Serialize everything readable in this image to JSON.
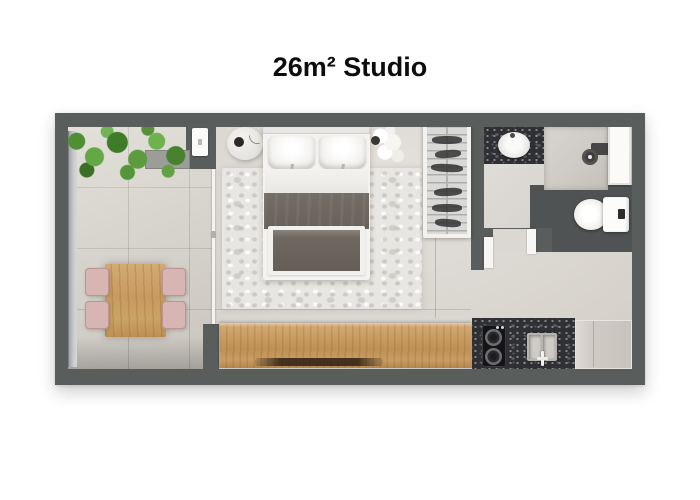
{
  "title": "26m² Studio",
  "plan": {
    "type": "apartment-floor-plan",
    "area_label": "26m²",
    "unit_type": "Studio",
    "rooms": [
      {
        "name": "balcony",
        "features": [
          "planter-plants",
          "dining-table",
          "four-pink-chairs",
          "glass-railing"
        ]
      },
      {
        "name": "living-bedroom",
        "features": [
          "double-bed",
          "round-nightstand",
          "rug",
          "flower-vase",
          "wardrobe-with-hangers",
          "wood-sideboard",
          "sliding-glass-door"
        ]
      },
      {
        "name": "bathroom",
        "features": [
          "vanity-sink",
          "shower",
          "glass-shelf",
          "toilet",
          "door-opening"
        ]
      },
      {
        "name": "kitchen",
        "features": [
          "two-burner-stove",
          "double-sink",
          "faucet",
          "fridge",
          "granite-counter"
        ]
      },
      {
        "name": "entry",
        "features": [
          "entry-door-opening"
        ]
      }
    ],
    "colors": {
      "wall": "#595d5c",
      "floor_living": "#dbd7d1",
      "floor_balcony": "#d6d2ca",
      "rug": "#e8e6e2",
      "wood": "#c79a60",
      "chair_pink": "#d7b5b2",
      "plant_green": "#55963a",
      "granite": "#2e3034",
      "blanket": "#6e6761",
      "fixtures_white": "#f4f3f1",
      "toilet_nook": "#4f5353",
      "background": "#ffffff",
      "title_text": "#0d0d0d"
    }
  }
}
